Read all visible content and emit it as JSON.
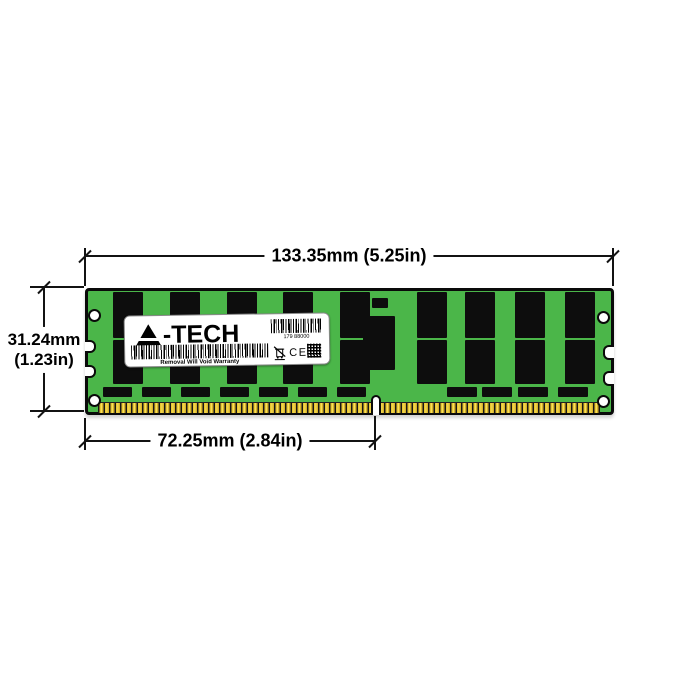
{
  "product": {
    "brand": "A-TECH",
    "type_note": "green PCB memory module with black chips and gold pins"
  },
  "label": {
    "logo_suffix": "-TECH",
    "barcode_number": "179 88000",
    "warranty_text": "Removal Will Void Warranty",
    "ce_text": "CE"
  },
  "dimensions": {
    "width": "133.35mm (5.25in)",
    "height_mm": "31.24mm",
    "height_in": "(1.23in)",
    "pins_width": "72.25mm (2.84in)"
  },
  "colors": {
    "pcb_green": "#4bb649",
    "chip_black": "#0d0d0d",
    "pin_gold": "#e9c733",
    "dimension_line": "#131313",
    "label_bg": "#ffffff",
    "background": "#ffffff"
  }
}
